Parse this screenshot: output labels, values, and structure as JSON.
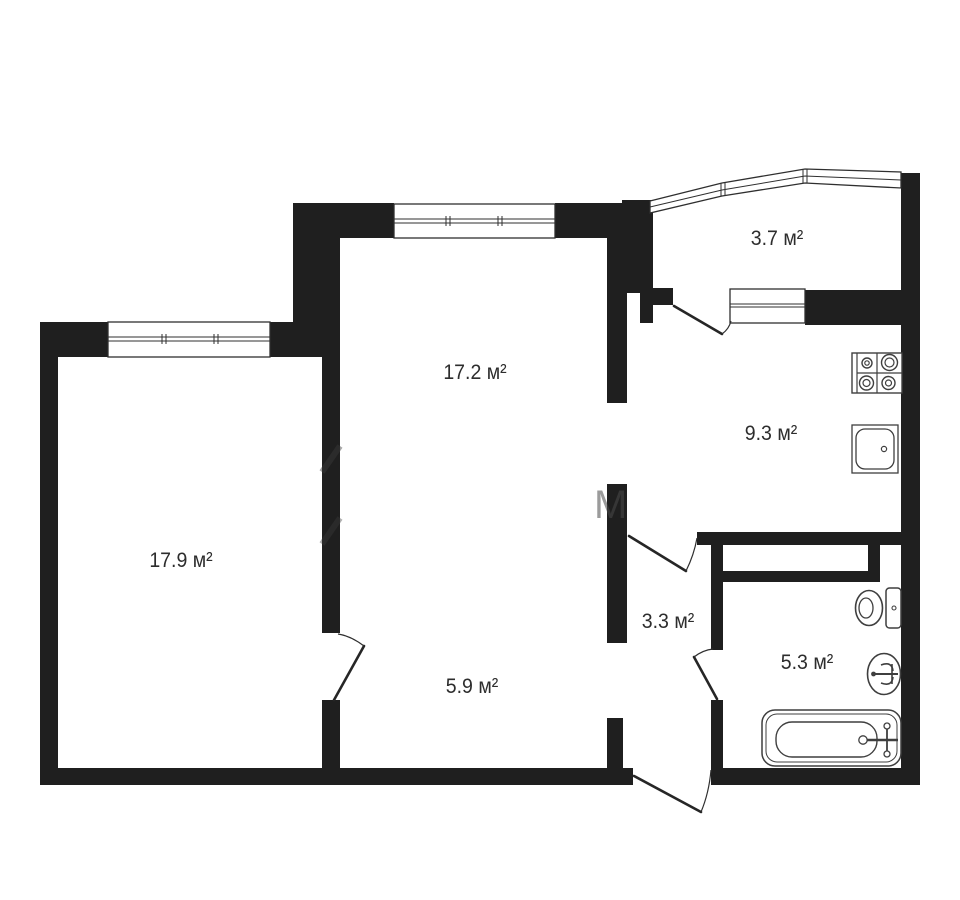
{
  "plan": {
    "title": "apartment-floor-plan",
    "area_unit": "м²",
    "rooms": [
      {
        "id": "balcony",
        "label": "3.7 м²",
        "area": 3.7
      },
      {
        "id": "living",
        "label": "17.2 м²",
        "area": 17.2
      },
      {
        "id": "kitchen",
        "label": "9.3 м²",
        "area": 9.3
      },
      {
        "id": "bedroom",
        "label": "17.9 м²",
        "area": 17.9
      },
      {
        "id": "hallway",
        "label": "3.3 м²",
        "area": 3.3
      },
      {
        "id": "corridor",
        "label": "5.9 м²",
        "area": 5.9
      },
      {
        "id": "bathroom",
        "label": "5.3 м²",
        "area": 5.3
      }
    ],
    "fixtures": [
      {
        "icon": "stove-icon",
        "room": "kitchen"
      },
      {
        "icon": "kitchen-sink-icon",
        "room": "kitchen"
      },
      {
        "icon": "toilet-icon",
        "room": "bathroom"
      },
      {
        "icon": "washbasin-icon",
        "room": "bathroom"
      },
      {
        "icon": "bathtub-icon",
        "room": "bathroom"
      }
    ],
    "colors": {
      "wall": "#1f1f1f",
      "line": "#3a3a3a",
      "text": "#2d2d2d",
      "bg": "#ffffff"
    }
  }
}
